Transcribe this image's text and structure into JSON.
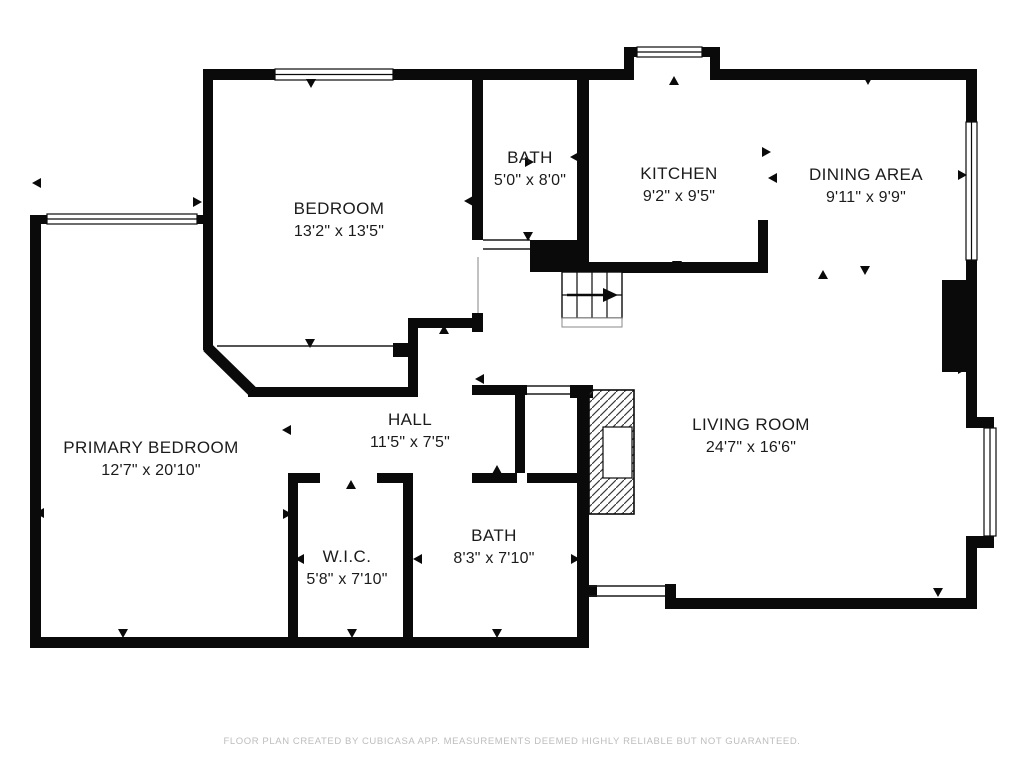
{
  "footer": {
    "credit": "FLOOR PLAN CREATED BY CUBICASA APP. MEASUREMENTS DEEMED HIGHLY RELIABLE BUT NOT GUARANTEED."
  },
  "colors": {
    "wall": "#0a0a0a",
    "label": "#1b1b1b",
    "footer_text": "#bdbdbd",
    "background": "#ffffff"
  },
  "icons": {
    "door_marker": "small-triangle",
    "stair_direction": "right-arrow"
  },
  "rooms": [
    {
      "id": "bedroom",
      "name": "BEDROOM",
      "dims": "13'2\" x 13'5\"",
      "cx": 339,
      "cy": 214
    },
    {
      "id": "bath-upper",
      "name": "BATH",
      "dims": "5'0\" x 8'0\"",
      "cx": 530,
      "cy": 163
    },
    {
      "id": "kitchen",
      "name": "KITCHEN",
      "dims": "9'2\" x 9'5\"",
      "cx": 679,
      "cy": 179
    },
    {
      "id": "dining-area",
      "name": "DINING AREA",
      "dims": "9'11\" x 9'9\"",
      "cx": 866,
      "cy": 180
    },
    {
      "id": "primary-bedroom",
      "name": "PRIMARY BEDROOM",
      "dims": "12'7\" x 20'10\"",
      "cx": 151,
      "cy": 453
    },
    {
      "id": "hall",
      "name": "HALL",
      "dims": "11'5\" x 7'5\"",
      "cx": 410,
      "cy": 425
    },
    {
      "id": "wic",
      "name": "W.I.C.",
      "dims": "5'8\" x 7'10\"",
      "cx": 347,
      "cy": 562
    },
    {
      "id": "bath-lower",
      "name": "BATH",
      "dims": "8'3\" x 7'10\"",
      "cx": 494,
      "cy": 541
    },
    {
      "id": "living-room",
      "name": "LIVING ROOM",
      "dims": "24'7\" x 16'6\"",
      "cx": 751,
      "cy": 430
    }
  ]
}
